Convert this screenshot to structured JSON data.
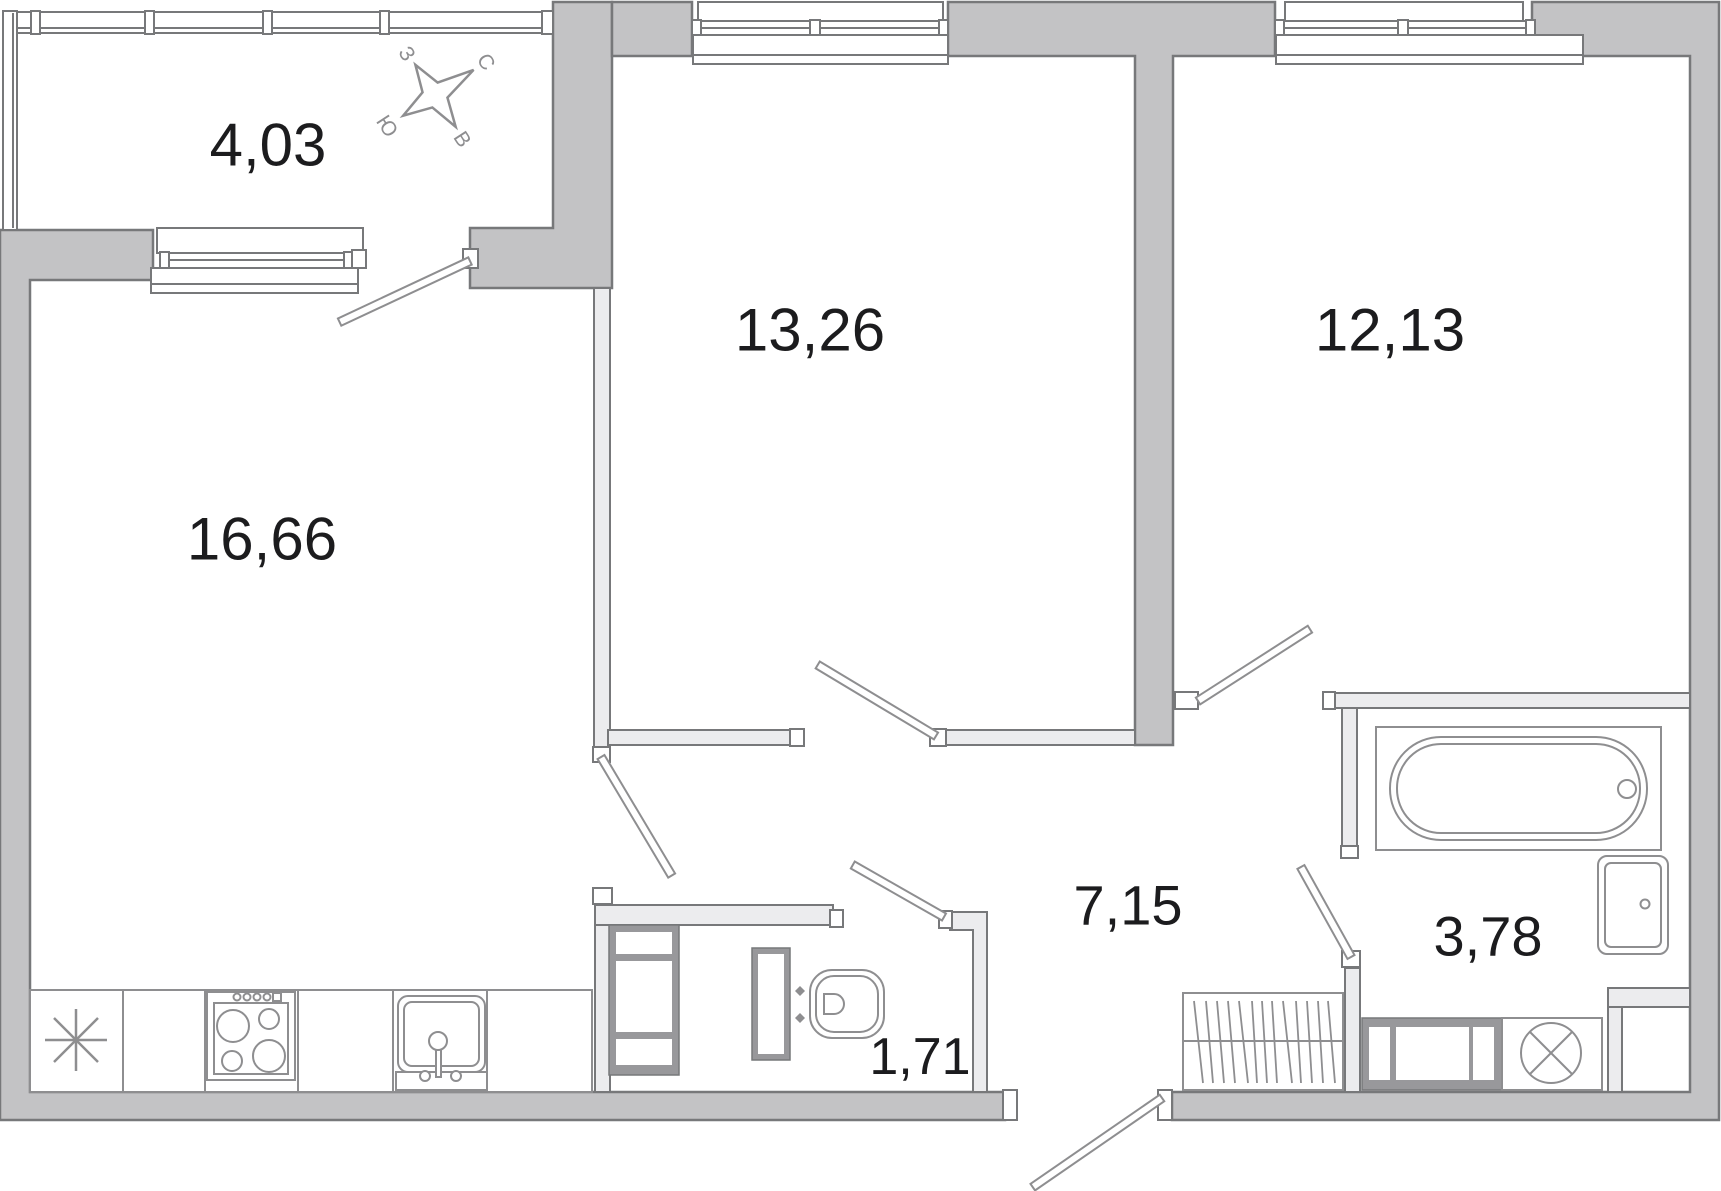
{
  "plan": {
    "type": "apartment-floor-plan",
    "language": "ru",
    "rooms": [
      {
        "name": "balcony",
        "area_m2": "4,03"
      },
      {
        "name": "living-kitchen",
        "area_m2": "16,66"
      },
      {
        "name": "bedroom-middle",
        "area_m2": "13,26"
      },
      {
        "name": "bedroom-right",
        "area_m2": "12,13"
      },
      {
        "name": "hallway",
        "area_m2": "7,15"
      },
      {
        "name": "wc",
        "area_m2": "1,71"
      },
      {
        "name": "bathroom",
        "area_m2": "3,78"
      }
    ],
    "compass": {
      "north_label": "С",
      "east_label": "В",
      "south_label": "Ю",
      "west_label": "З"
    },
    "colors": {
      "wall_fill": "#c3c3c5",
      "partition_fill": "#ececee",
      "outline": "#77787a",
      "fixture_outline": "#8e8e90",
      "frame_fill": "#98989b",
      "label_text": "#1c1c1e",
      "background": "#ffffff"
    }
  }
}
